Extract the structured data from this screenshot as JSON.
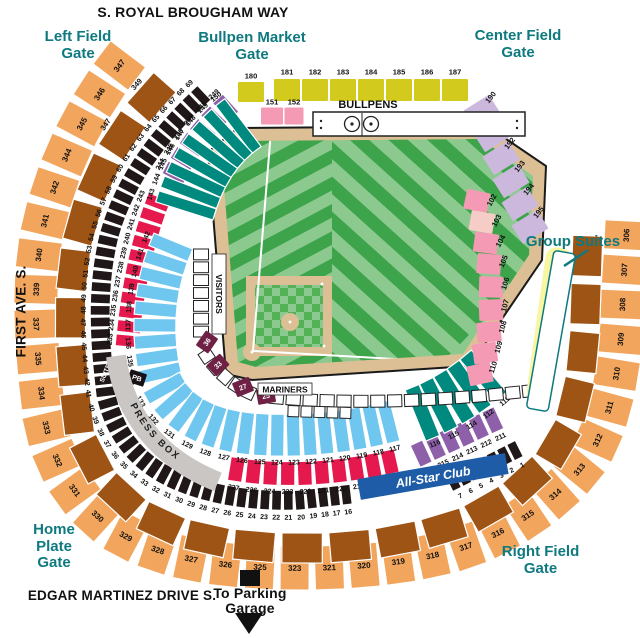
{
  "streets": {
    "top": "S. ROYAL BROUGHAM WAY",
    "left": "FIRST AVE. S.",
    "bottom": "EDGAR MARTINEZ DRIVE S."
  },
  "gates": {
    "left_field": "Left Field\nGate",
    "bullpen_market": "Bullpen Market\nGate",
    "center_field": "Center Field\nGate",
    "home_plate": "Home\nPlate\nGate",
    "right_field": "Right Field\nGate"
  },
  "labels": {
    "group_suites": "Group Suites",
    "hit_it_here_cafe": "Hit it Here Cafe",
    "all_star_club": "All-Star Club",
    "press_box": "PRESS BOX",
    "bullpens": "BULLPENS",
    "visitors": "VISITORS",
    "mariners": "MARINERS",
    "to_parking": "To Parking\nGarage",
    "suite": "SUITE"
  },
  "colors": {
    "teal_text": "#0E7A80",
    "orange": "#F2A55C",
    "brown": "#9E5414",
    "black_section": "#201718",
    "crimson": "#E5194E",
    "purple": "#8E60AA",
    "sky_blue": "#6FC6EF",
    "teal_section": "#00897F",
    "yellow_green": "#D2CA1C",
    "pink": "#F49AB4",
    "pale_pink": "#F6CCC6",
    "lavender": "#CBB8DC",
    "cafe_yellow": "#F8F5A3",
    "club_blue": "#1E5CA8",
    "maroon": "#6E2145",
    "press_gray": "#C9C6C3",
    "field_light": "#8CC98F",
    "field_dark": "#3EA44B",
    "dirt": "#DCBF94"
  },
  "rings": [
    {
      "id": "view-300",
      "color": "#F2A55C",
      "th": 44,
      "fs": 8,
      "path": "M 130,52 C 95,95 62,150 45,220 C 33,270 33,330 45,420 C 55,470 80,505 115,530 C 160,558 220,568 300,568 C 360,568 410,562 455,550 C 505,535 560,500 590,455 C 610,420 620,370 622,315 C 623,280 626,250 627,218",
      "labels": [
        "347",
        "346",
        "345",
        "344",
        "342",
        "341",
        "340",
        "339",
        "337",
        "335",
        "334",
        "333",
        "332",
        "331",
        "330",
        "329",
        "328",
        "327",
        "326",
        "325",
        "323",
        "321",
        "320",
        "319",
        "318",
        "317",
        "316",
        "315",
        "314",
        "313",
        "312",
        "311",
        "310",
        "309",
        "308",
        "307",
        "306"
      ]
    },
    {
      "id": "club-200-brown",
      "color": "#9E5414",
      "th": 30,
      "labelOut": 20,
      "path": "M 168,80 C 118,130 92,180 78,240 C 68,290 68,340 78,420 C 88,462 108,490 140,512 C 180,538 235,548 305,548 C 360,548 405,540 445,528 C 488,515 532,485 558,445 C 575,415 583,372 585,320 C 586,288 587,260 588,232",
      "labels": [
        "349",
        "347",
        "",
        "",
        "",
        "",
        "",
        "",
        "",
        "",
        "",
        "",
        "",
        "",
        "",
        "",
        "",
        "",
        "",
        "",
        "",
        "",
        "",
        ""
      ]
    },
    {
      "id": "suites",
      "color": "#201718",
      "th": 20,
      "fs": 7,
      "labelOut": 17,
      "path": "M 205,92 C 155,138 122,185 108,240 C 98,285 98,330 106,395 C 114,430 132,455 160,472 C 198,494 250,502 300,500 L 352,494",
      "labels": [
        "69",
        "68",
        "67",
        "66",
        "65",
        "64",
        "63",
        "62",
        "61",
        "60",
        "59",
        "58",
        "57",
        "56",
        "55",
        "54",
        "53",
        "52",
        "51",
        "50",
        "49",
        "48",
        "47",
        "46",
        "45",
        "44",
        "43",
        "42",
        "41",
        "40",
        "39",
        "38",
        "37",
        "36",
        "35",
        "34",
        "33",
        "32",
        "31",
        "30",
        "29",
        "28",
        "27",
        "26",
        "25",
        "24",
        "23",
        "22",
        "21",
        "20",
        "19",
        "18",
        "17",
        "16"
      ]
    },
    {
      "id": "suites-rf",
      "color": "#201718",
      "th": 18,
      "fs": 7,
      "labelOut": 16,
      "path": "M 448,484 L 520,448",
      "labels": [
        "7",
        "6",
        "5",
        "4",
        "3",
        "2",
        "1"
      ]
    },
    {
      "id": "purple-lf",
      "color": "#8E60AA",
      "th": 24,
      "fs": 7,
      "labelOut": 18,
      "path": "M 232,102 C 205,125 188,148 172,180",
      "labels": [
        "249",
        "248",
        "247",
        "246",
        "245",
        "244"
      ]
    },
    {
      "id": "crimson-lf",
      "color": "#E5194E",
      "th": 24,
      "fs": 7,
      "labelOut": 18,
      "path": "M 160,196 C 142,240 132,290 127,348",
      "labels": [
        "243",
        "242",
        "241",
        "240",
        "239",
        "238",
        "237",
        "236",
        "235",
        "234",
        "233"
      ]
    },
    {
      "id": "crimson-home",
      "color": "#E5194E",
      "th": 24,
      "fs": 7,
      "labelOut": 18,
      "path": "M 228,468 C 280,478 340,474 398,460",
      "labels": [
        "227",
        "226",
        "224",
        "223",
        "222",
        "221",
        "220",
        "219",
        "218",
        "217"
      ]
    },
    {
      "id": "purple-rf",
      "color": "#8E60AA",
      "th": 24,
      "fs": 7,
      "labelOut": 18,
      "path": "M 414,457 L 500,417",
      "labels": [
        "216",
        "215",
        "214",
        "213",
        "212",
        "211"
      ]
    },
    {
      "id": "teal-lf-100",
      "color": "#00897F",
      "th": 60,
      "fs": 7,
      "labelOut": 37,
      "path": "M 244,122 C 215,142 196,170 184,212",
      "labels": [
        "150",
        "149",
        "148",
        "147",
        "146",
        "145",
        "144",
        "143"
      ]
    },
    {
      "id": "blue-100",
      "color": "#6FC6EF",
      "th": 42,
      "fs": 7,
      "labelOut": 27,
      "path": "M 174,240 C 152,288 150,340 163,385 C 178,415 210,430 252,434 C 300,438 352,432 396,420",
      "labels": [
        "142",
        "141",
        "140",
        "139",
        "138",
        "137",
        "136",
        "135",
        "134",
        "133",
        "132",
        "131",
        "129",
        "128",
        "127",
        "126",
        "125",
        "124",
        "123",
        "122",
        "121",
        "120",
        "119",
        "118",
        "117"
      ]
    },
    {
      "id": "teal-rf-100",
      "color": "#00897F",
      "th": 55,
      "fs": 7,
      "labelOut": 33,
      "path": "M 414,416 C 442,406 468,390 490,370",
      "labels": [
        "116",
        "115",
        "114",
        "112",
        "111"
      ]
    },
    {
      "id": "visitors-boxes",
      "color": "#ffffff",
      "stroke": "#222",
      "th": 15,
      "count": 7,
      "path": "M 201,248 L 201,338",
      "labels": []
    },
    {
      "id": "home-boxes",
      "color": "#ffffff",
      "stroke": "#222",
      "th": 13,
      "count": 5,
      "path": "M 203,350 Q 222,382 255,395",
      "labels": []
    },
    {
      "id": "mariners-boxes",
      "color": "#ffffff",
      "stroke": "#222",
      "th": 12,
      "count": 16,
      "path": "M 268,397 C 340,404 420,402 500,394 L 538,390",
      "labels": []
    },
    {
      "id": "mariners-boxes-2",
      "color": "#ffffff",
      "stroke": "#222",
      "th": 11,
      "count": 5,
      "path": "M 287,411 L 352,413",
      "labels": []
    }
  ],
  "spots": [
    {
      "id": "s180",
      "x": 251,
      "y": 92,
      "w": 26,
      "h": 20,
      "rot": 0,
      "color": "#D2CA1C",
      "label": "180",
      "ldx": 0,
      "ldy": -16,
      "lrot": 0
    },
    {
      "id": "s181",
      "x": 287,
      "y": 90,
      "w": 26,
      "h": 22,
      "rot": 0,
      "color": "#D2CA1C",
      "label": "181",
      "ldx": 0,
      "ldy": -18,
      "lrot": 0
    },
    {
      "id": "s182",
      "x": 315,
      "y": 90,
      "w": 26,
      "h": 22,
      "rot": 0,
      "color": "#D2CA1C",
      "label": "182",
      "ldx": 0,
      "ldy": -18,
      "lrot": 0
    },
    {
      "id": "s183",
      "x": 343,
      "y": 90,
      "w": 26,
      "h": 22,
      "rot": 0,
      "color": "#D2CA1C",
      "label": "183",
      "ldx": 0,
      "ldy": -18,
      "lrot": 0
    },
    {
      "id": "s184",
      "x": 371,
      "y": 90,
      "w": 26,
      "h": 22,
      "rot": 0,
      "color": "#D2CA1C",
      "label": "184",
      "ldx": 0,
      "ldy": -18,
      "lrot": 0
    },
    {
      "id": "s185",
      "x": 399,
      "y": 90,
      "w": 26,
      "h": 22,
      "rot": 0,
      "color": "#D2CA1C",
      "label": "185",
      "ldx": 0,
      "ldy": -18,
      "lrot": 0
    },
    {
      "id": "s186",
      "x": 427,
      "y": 90,
      "w": 26,
      "h": 22,
      "rot": 0,
      "color": "#D2CA1C",
      "label": "186",
      "ldx": 0,
      "ldy": -18,
      "lrot": 0
    },
    {
      "id": "s187",
      "x": 455,
      "y": 90,
      "w": 26,
      "h": 22,
      "rot": 0,
      "color": "#D2CA1C",
      "label": "187",
      "ldx": 0,
      "ldy": -18,
      "lrot": 0
    },
    {
      "id": "s151",
      "x": 272,
      "y": 116,
      "w": 22,
      "h": 17,
      "rot": 0,
      "color": "#F49AB4",
      "label": "151",
      "ldx": 0,
      "ldy": -14,
      "lrot": 0
    },
    {
      "id": "s152",
      "x": 294,
      "y": 116,
      "w": 19,
      "h": 17,
      "rot": 0,
      "color": "#F49AB4",
      "label": "152",
      "ldx": 0,
      "ldy": -14,
      "lrot": 0
    },
    {
      "id": "s190",
      "x": 482,
      "y": 112,
      "w": 30,
      "h": 22,
      "rot": -32,
      "color": "#CBB8DC",
      "label": "190",
      "ldx": 15,
      "ldy": -8,
      "lrot": -52
    },
    {
      "id": "s191",
      "x": 492,
      "y": 135,
      "w": 30,
      "h": 22,
      "rot": -32,
      "color": "#CBB8DC",
      "label": "191",
      "ldx": 15,
      "ldy": -8,
      "lrot": -52
    },
    {
      "id": "s192",
      "x": 501,
      "y": 158,
      "w": 30,
      "h": 22,
      "rot": -32,
      "color": "#CBB8DC",
      "label": "192",
      "ldx": 15,
      "ldy": -8,
      "lrot": -52
    },
    {
      "id": "s193",
      "x": 511,
      "y": 181,
      "w": 30,
      "h": 22,
      "rot": -32,
      "color": "#CBB8DC",
      "label": "193",
      "ldx": 15,
      "ldy": -8,
      "lrot": -52
    },
    {
      "id": "s194",
      "x": 520,
      "y": 204,
      "w": 30,
      "h": 22,
      "rot": -32,
      "color": "#CBB8DC",
      "label": "194",
      "ldx": 15,
      "ldy": -8,
      "lrot": -52
    },
    {
      "id": "s195",
      "x": 530,
      "y": 227,
      "w": 30,
      "h": 22,
      "rot": -32,
      "color": "#CBB8DC",
      "label": "195",
      "ldx": 15,
      "ldy": -8,
      "lrot": -52
    },
    {
      "id": "s102",
      "x": 477,
      "y": 201,
      "w": 24,
      "h": 20,
      "rot": 12,
      "color": "#F49AB4",
      "label": "102",
      "ldx": 14,
      "ldy": -4,
      "lrot": -62
    },
    {
      "id": "s103",
      "x": 482,
      "y": 222,
      "w": 24,
      "h": 20,
      "rot": 10,
      "color": "#F6CCC6",
      "label": "103",
      "ldx": 14,
      "ldy": -4,
      "lrot": -62
    },
    {
      "id": "s104",
      "x": 486,
      "y": 243,
      "w": 24,
      "h": 20,
      "rot": 8,
      "color": "#F49AB4",
      "label": "104",
      "ldx": 14,
      "ldy": -4,
      "lrot": -62
    },
    {
      "id": "s105",
      "x": 489,
      "y": 264,
      "w": 24,
      "h": 20,
      "rot": 5,
      "color": "#F49AB4",
      "label": "105",
      "ldx": 14,
      "ldy": -4,
      "lrot": -68
    },
    {
      "id": "s106",
      "x": 491,
      "y": 287,
      "w": 24,
      "h": 21,
      "rot": 2,
      "color": "#F49AB4",
      "label": "106",
      "ldx": 14,
      "ldy": -4,
      "lrot": -72
    },
    {
      "id": "s107",
      "x": 491,
      "y": 310,
      "w": 24,
      "h": 21,
      "rot": -2,
      "color": "#F49AB4",
      "label": "107",
      "ldx": 14,
      "ldy": -4,
      "lrot": -75
    },
    {
      "id": "s108",
      "x": 489,
      "y": 332,
      "w": 24,
      "h": 20,
      "rot": -5,
      "color": "#F49AB4",
      "label": "108",
      "ldx": 14,
      "ldy": -4,
      "lrot": -75
    },
    {
      "id": "s109",
      "x": 485,
      "y": 353,
      "w": 24,
      "h": 20,
      "rot": -8,
      "color": "#F49AB4",
      "label": "109",
      "ldx": 14,
      "ldy": -4,
      "lrot": -75
    },
    {
      "id": "s110",
      "x": 480,
      "y": 374,
      "w": 24,
      "h": 20,
      "rot": -12,
      "color": "#F49AB4",
      "label": "110",
      "ldx": 14,
      "ldy": -4,
      "lrot": -72
    },
    {
      "id": "s36",
      "x": 207,
      "y": 342,
      "w": 18,
      "h": 15,
      "rot": -55,
      "color": "#6E2145",
      "label": "36",
      "labelColor": "#fff",
      "ldx": 0,
      "ldy": 0,
      "lrot": -55,
      "fs": 7
    },
    {
      "id": "s33",
      "x": 218,
      "y": 365,
      "w": 18,
      "h": 15,
      "rot": -42,
      "color": "#6E2145",
      "label": "33",
      "labelColor": "#fff",
      "ldx": 0,
      "ldy": 0,
      "lrot": -42,
      "fs": 7
    },
    {
      "id": "s27",
      "x": 243,
      "y": 387,
      "w": 18,
      "h": 15,
      "rot": -22,
      "color": "#6E2145",
      "label": "27",
      "labelColor": "#fff",
      "ldx": 0,
      "ldy": 0,
      "lrot": -22,
      "fs": 7
    },
    {
      "id": "s25",
      "x": 266,
      "y": 396,
      "w": 18,
      "h": 15,
      "rot": -10,
      "color": "#6E2145",
      "label": "25",
      "labelColor": "#fff",
      "ldx": 0,
      "ldy": 0,
      "lrot": -10,
      "fs": 7
    },
    {
      "id": "pb-box",
      "x": 137,
      "y": 378,
      "w": 17,
      "h": 13,
      "rot": 18,
      "color": "#171215",
      "label": "PB",
      "labelColor": "#fff",
      "ldx": 0,
      "ldy": 0,
      "lrot": 18,
      "fs": 7
    },
    {
      "id": "suite-text",
      "x": 105,
      "y": 373,
      "w": 0,
      "h": 0,
      "rot": 0,
      "color": "none",
      "label": "SUITE",
      "labelColor": "#fff",
      "ldx": 0,
      "ldy": 0,
      "lrot": -68,
      "fs": 6.5
    },
    {
      "id": "suiteA",
      "x": 540,
      "y": 396,
      "w": 12,
      "h": 12,
      "rot": 10,
      "color": "#171215",
      "label": "A",
      "labelColor": "#fff",
      "ldx": 0,
      "ldy": 0,
      "lrot": 10,
      "fs": 7
    },
    {
      "id": "suiteB",
      "x": 543,
      "y": 377,
      "w": 12,
      "h": 12,
      "rot": 10,
      "color": "#171215",
      "label": "B",
      "labelColor": "#fff",
      "ldx": 0,
      "ldy": 0,
      "lrot": 10,
      "fs": 7
    },
    {
      "id": "suiteC",
      "x": 546,
      "y": 358,
      "w": 12,
      "h": 12,
      "rot": 10,
      "color": "#171215",
      "label": "C",
      "labelColor": "#fff",
      "ldx": 0,
      "ldy": 0,
      "lrot": 10,
      "fs": 7
    },
    {
      "id": "suiteD",
      "x": 549,
      "y": 340,
      "w": 12,
      "h": 12,
      "rot": 10,
      "color": "#171215",
      "label": "D",
      "labelColor": "#fff",
      "ldx": 0,
      "ldy": 0,
      "lrot": 10,
      "fs": 7
    },
    {
      "id": "suiteE",
      "x": 553,
      "y": 321,
      "w": 12,
      "h": 12,
      "rot": 10,
      "color": "#171215",
      "label": "E",
      "labelColor": "#fff",
      "ldx": 0,
      "ldy": 0,
      "lrot": 10,
      "fs": 7
    },
    {
      "id": "suiteF",
      "x": 556,
      "y": 302,
      "w": 12,
      "h": 12,
      "rot": 10,
      "color": "#171215",
      "label": "F",
      "labelColor": "#fff",
      "ldx": 0,
      "ldy": 0,
      "lrot": 10,
      "fs": 7
    },
    {
      "id": "suiteG",
      "x": 559,
      "y": 284,
      "w": 12,
      "h": 12,
      "rot": 10,
      "color": "#171215",
      "label": "G",
      "labelColor": "#fff",
      "ldx": 0,
      "ldy": 0,
      "lrot": 10,
      "fs": 7
    },
    {
      "id": "suiteH",
      "x": 562,
      "y": 265,
      "w": 12,
      "h": 12,
      "rot": 10,
      "color": "#171215",
      "label": "H",
      "labelColor": "#fff",
      "ldx": 0,
      "ldy": 0,
      "lrot": 10,
      "fs": 7
    }
  ]
}
